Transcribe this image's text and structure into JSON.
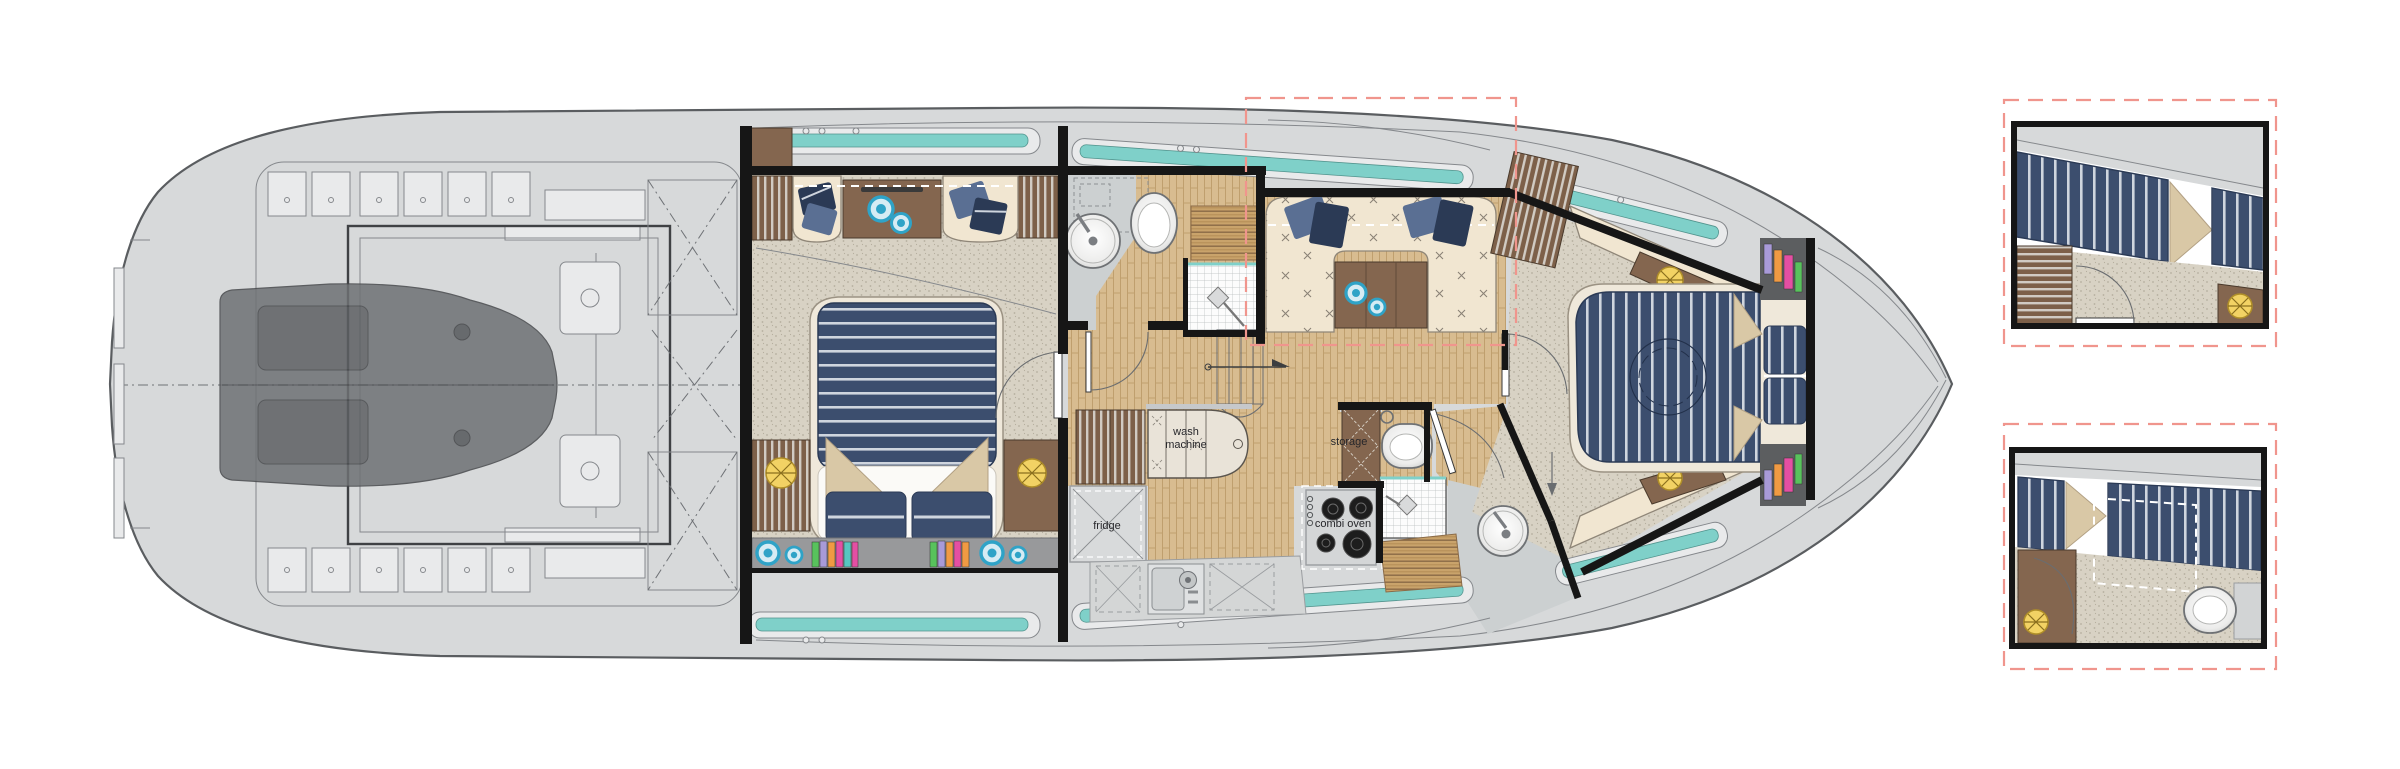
{
  "figure": {
    "kind": "yacht lower-deck floor plan with two cabin detail insets"
  },
  "plan": {
    "labels": {
      "wash_line1": "wash",
      "wash_line2": "machine",
      "storage": "storage",
      "fridge": "fridge",
      "combi_oven": "combi oven"
    }
  },
  "palette": {
    "hull_deck": "#d7d9da",
    "hull_outline": "#5a5d60",
    "wireframe": "#85888c",
    "engine_dark": "#6e7174",
    "wall_black": "#161616",
    "carpet": "#d8d2c4",
    "carpet_dot": "#b5ae9e",
    "wood_floor": "#d8bc90",
    "wood_floor_line": "#bf9f6e",
    "wood_dark": "#84664f",
    "wood_mid": "#9a7a5e",
    "cream": "#f1e6d1",
    "cream_line": "#8f8678",
    "navy": "#3c4e6e",
    "navy_dark": "#2b3a55",
    "pillow_blue": "#5a6f93",
    "teal": "#7fd0c9",
    "yellow": "#f2d264",
    "blue_decor": "#2fa3c7",
    "pink_dash": "#f0958d",
    "gray_floor": "#ccd0d1",
    "counter_gray": "#d4d6d6",
    "burner_black": "#1d1d1d",
    "beige_fold": "#d9c8a6",
    "book_purple": "#a89ad8",
    "book_orange": "#f09a43",
    "book_pink": "#e44fa3",
    "book_green": "#58c25c",
    "book_teal": "#57c6c0",
    "shelf_gray": "#98999b"
  }
}
